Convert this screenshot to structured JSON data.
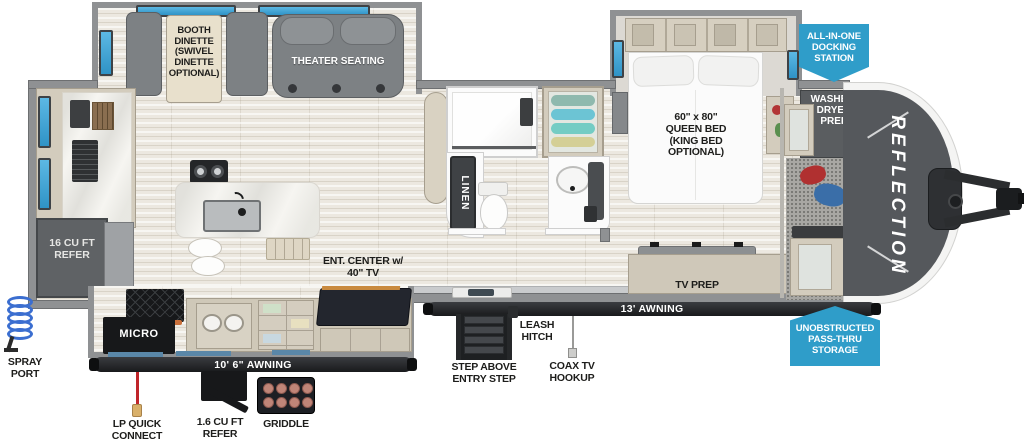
{
  "brand": "REFLECTION",
  "colors": {
    "badge_blue": "#2F9DC9",
    "window_blue": "#45A7D9",
    "lp_red": "#C0252A"
  },
  "badges": {
    "docking_station": "ALL-IN-ONE\nDOCKING\nSTATION",
    "pass_thru_storage": "UNOBSTRUCTED\nPASS-THRU\nSTORAGE"
  },
  "living_area": {
    "booth_dinette": "BOOTH\nDINETTE\n(SWIVEL\nDINETTE\nOPTIONAL)",
    "theater_seating": "THEATER SEATING",
    "ent_center": "ENT. CENTER w/\n40\" TV",
    "refrigerator": "16 CU FT\nREFER",
    "microwave": "MICRO"
  },
  "bathroom": {
    "linen": "LINEN"
  },
  "bedroom": {
    "bed": "60\" x 80\"\nQUEEN BED\n(KING BED\nOPTIONAL)",
    "tv_prep": "TV PREP",
    "washer_dryer_prep": "WASHER/\nDRYER\nPREP"
  },
  "exterior": {
    "awning_main": "13' AWNING",
    "awning_kitchen": "10' 6\" AWNING",
    "spray_port": "SPRAY\nPORT",
    "lp_quick_connect": "LP QUICK\nCONNECT",
    "outside_refer": "1.6 CU FT\nREFER",
    "griddle": "GRIDDLE",
    "leash_hitch": "LEASH\nHITCH",
    "entry_step": "STEP ABOVE\nENTRY STEP",
    "coax_hookup": "COAX TV\nHOOKUP"
  }
}
